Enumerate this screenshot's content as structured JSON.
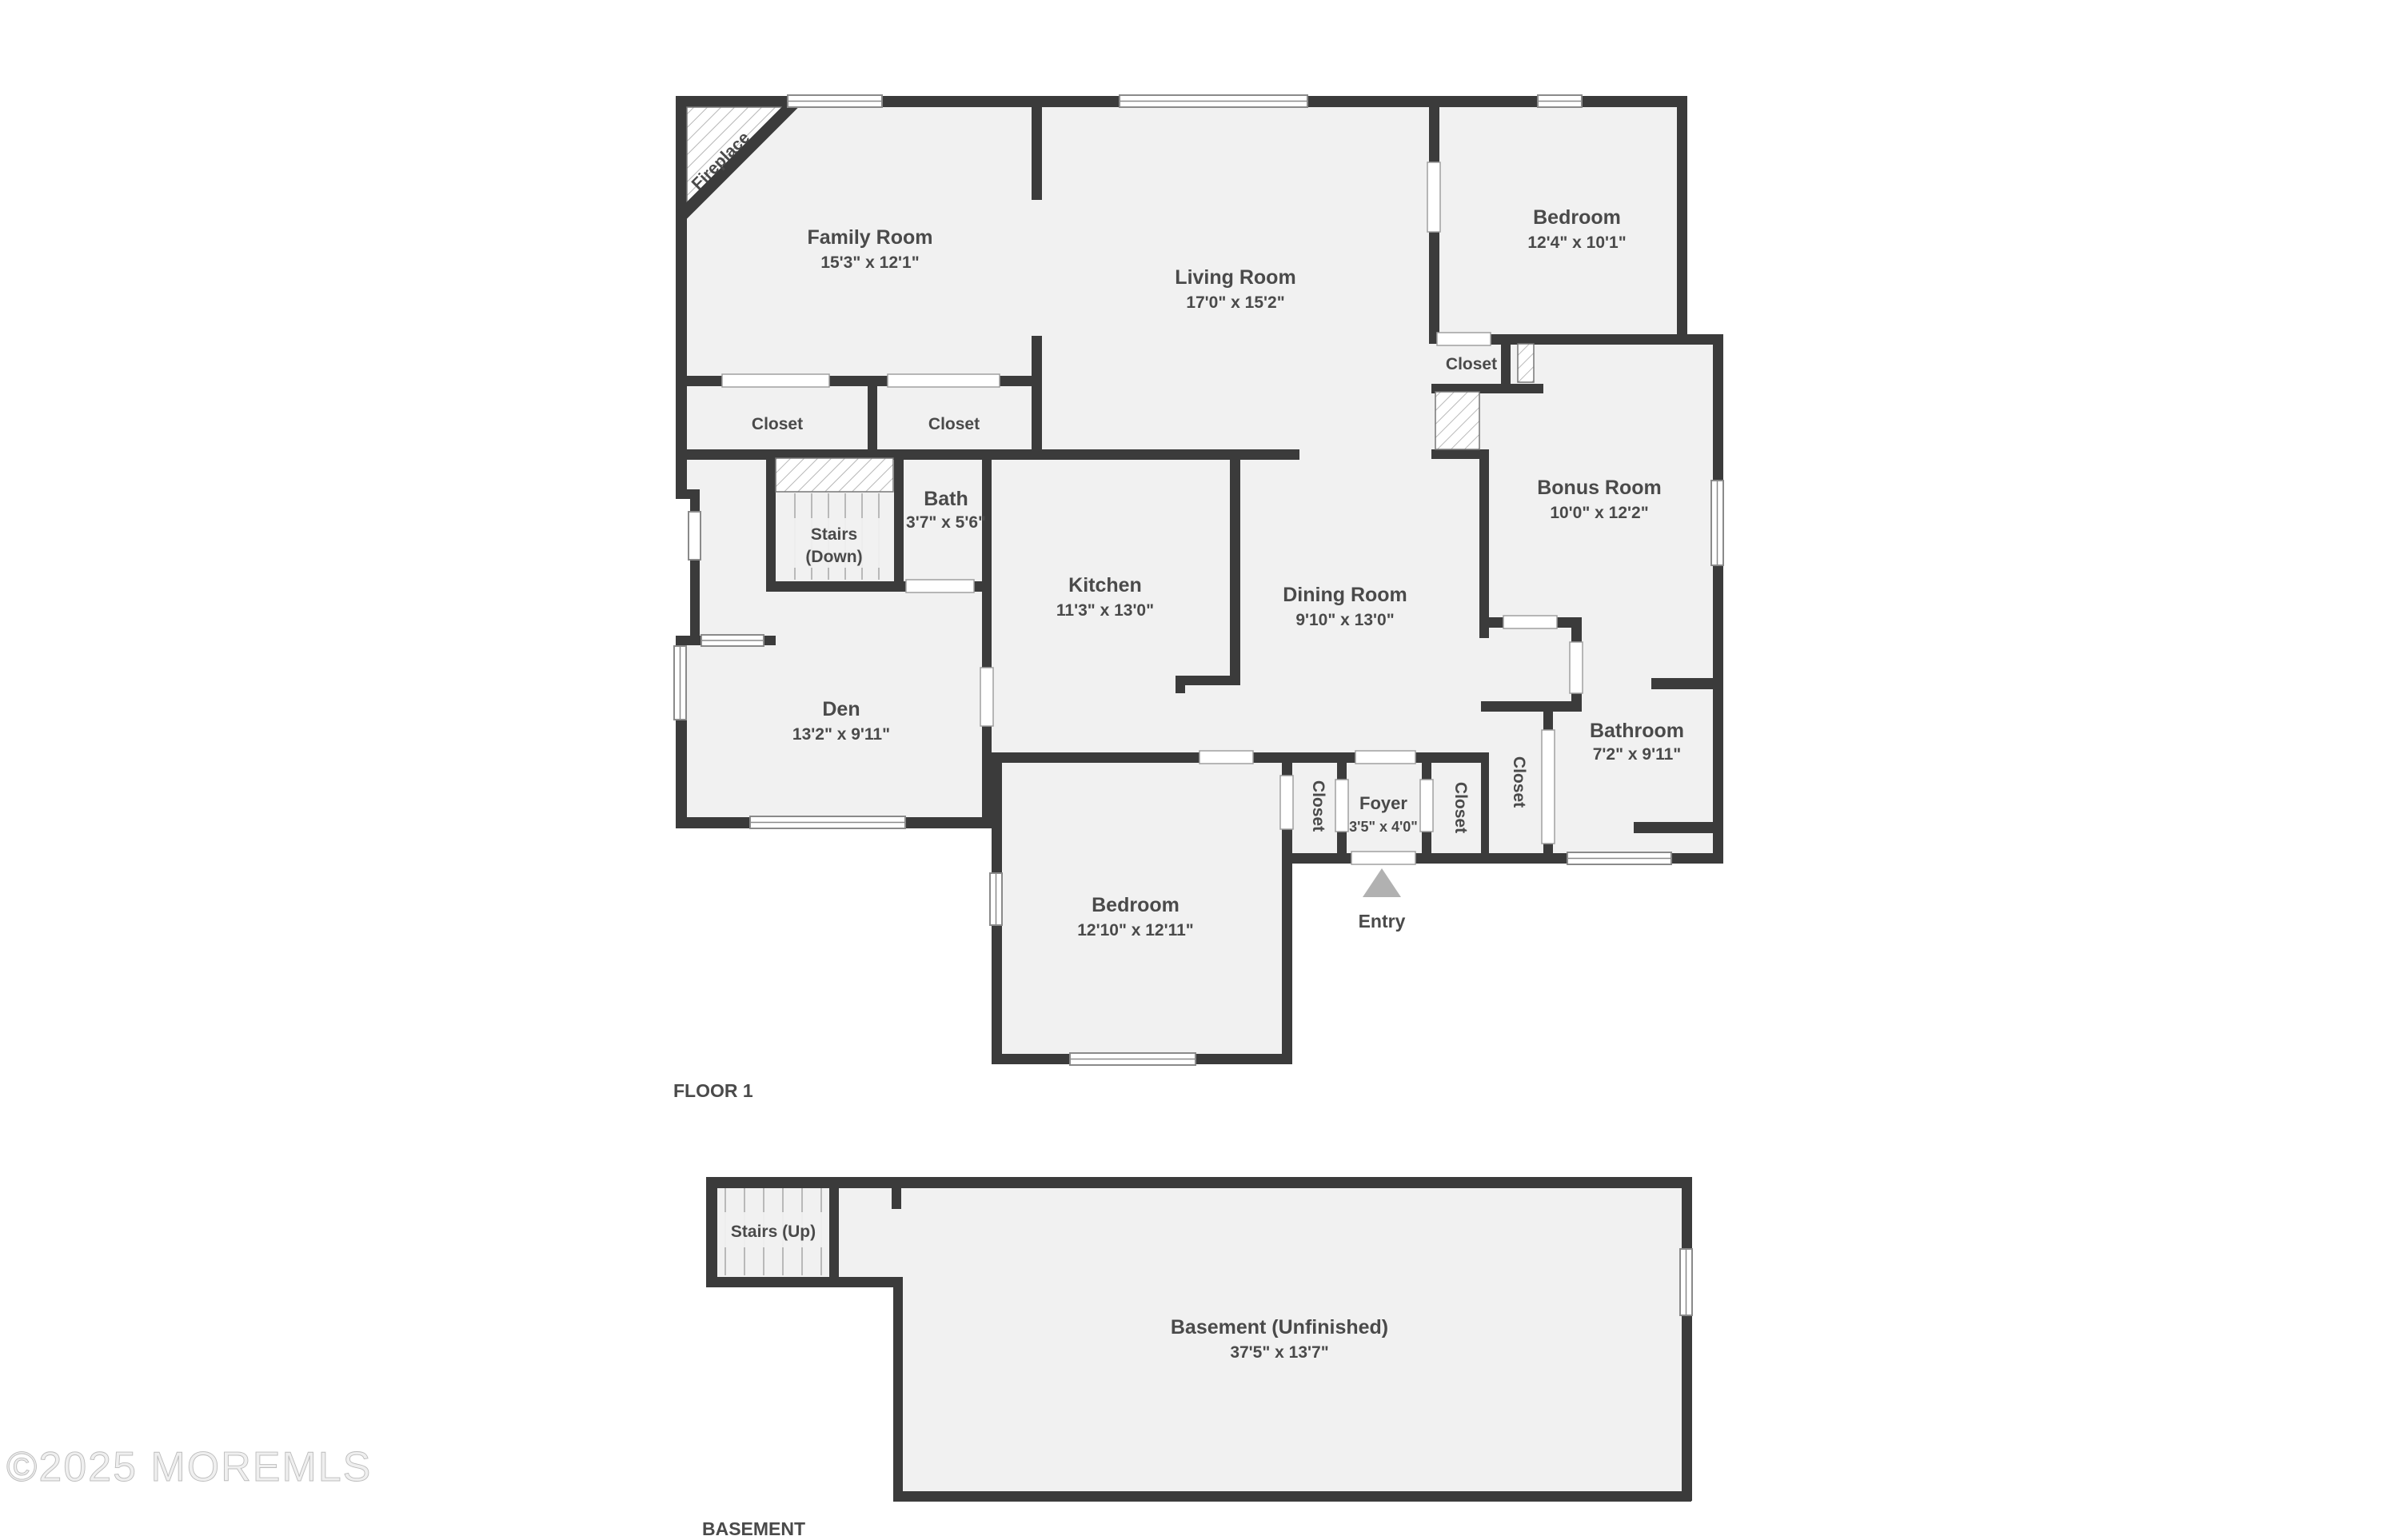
{
  "floor1": {
    "caption": "FLOOR 1",
    "rooms": {
      "family": {
        "name": "Family Room",
        "dims": "15'3\" x 12'1\""
      },
      "living": {
        "name": "Living Room",
        "dims": "17'0\" x 15'2\""
      },
      "bedroom_top": {
        "name": "Bedroom",
        "dims": "12'4\" x 10'1\""
      },
      "bonus": {
        "name": "Bonus Room",
        "dims": "10'0\" x 12'2\""
      },
      "bath": {
        "name": "Bath",
        "dims": "3'7\" x 5'6\""
      },
      "kitchen": {
        "name": "Kitchen",
        "dims": "11'3\" x 13'0\""
      },
      "dining": {
        "name": "Dining Room",
        "dims": "9'10\" x 13'0\""
      },
      "den": {
        "name": "Den",
        "dims": "13'2\" x 9'11\""
      },
      "bathroom": {
        "name": "Bathroom",
        "dims": "7'2\" x 9'11\""
      },
      "foyer": {
        "name": "Foyer",
        "dims": "3'5\" x 4'0\""
      },
      "bedroom_bottom": {
        "name": "Bedroom",
        "dims": "12'10\" x 12'11\""
      }
    },
    "stairs_down": {
      "line1": "Stairs",
      "line2": "(Down)"
    },
    "closet_label": "Closet",
    "fireplace_label": "Fireplace",
    "entry_label": "Entry"
  },
  "basement": {
    "caption": "BASEMENT",
    "room": {
      "name": "Basement (Unfinished)",
      "dims": "37'5\" x 13'7\""
    },
    "stairs_label": "Stairs (Up)"
  },
  "watermark": "©2025 MOREMLS",
  "colors": {
    "wall": "#3b3b3b",
    "room_fill": "#f1f1f1",
    "label_text": "#4a4a4a",
    "entry_arrow": "#b1b1b1",
    "watermark": "#e0e0e0"
  }
}
